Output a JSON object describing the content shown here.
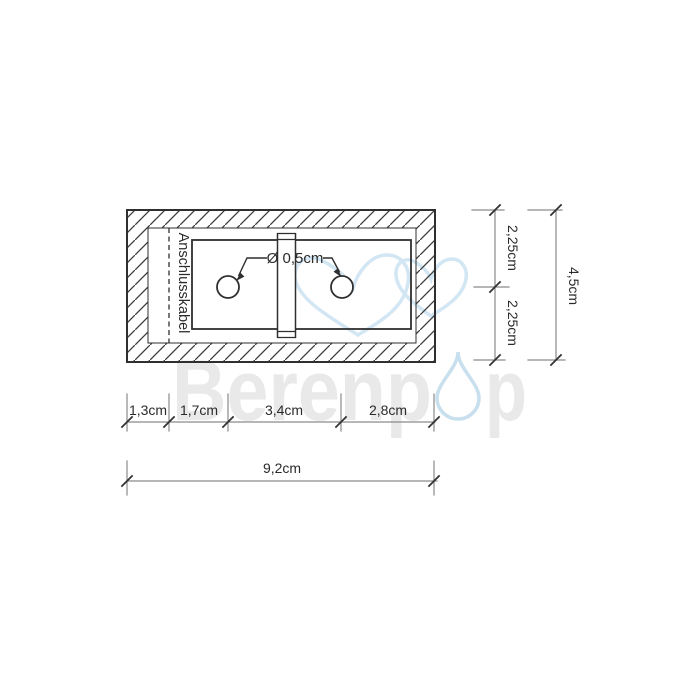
{
  "drawing": {
    "cable_label": "Anschlusskabel",
    "hole_diameter_label": "Ø 0,5cm"
  },
  "dimensions": {
    "right_top": "2,25cm",
    "right_bottom": "2,25cm",
    "right_total": "4,5cm",
    "bottom_segments": [
      "1,3cm",
      "1,7cm",
      "3,4cm",
      "2,8cm"
    ],
    "bottom_total": "9,2cm"
  },
  "watermark": {
    "full_name": "Berenpop",
    "text_before_drop": "Berenp",
    "text_after_drop": "p",
    "gray": "#e9e9e9",
    "blue": "#cadfee"
  },
  "colors": {
    "drawing_line": "#2f2f2f",
    "dimension_line": "#8a8a8a",
    "background": "#ffffff"
  }
}
